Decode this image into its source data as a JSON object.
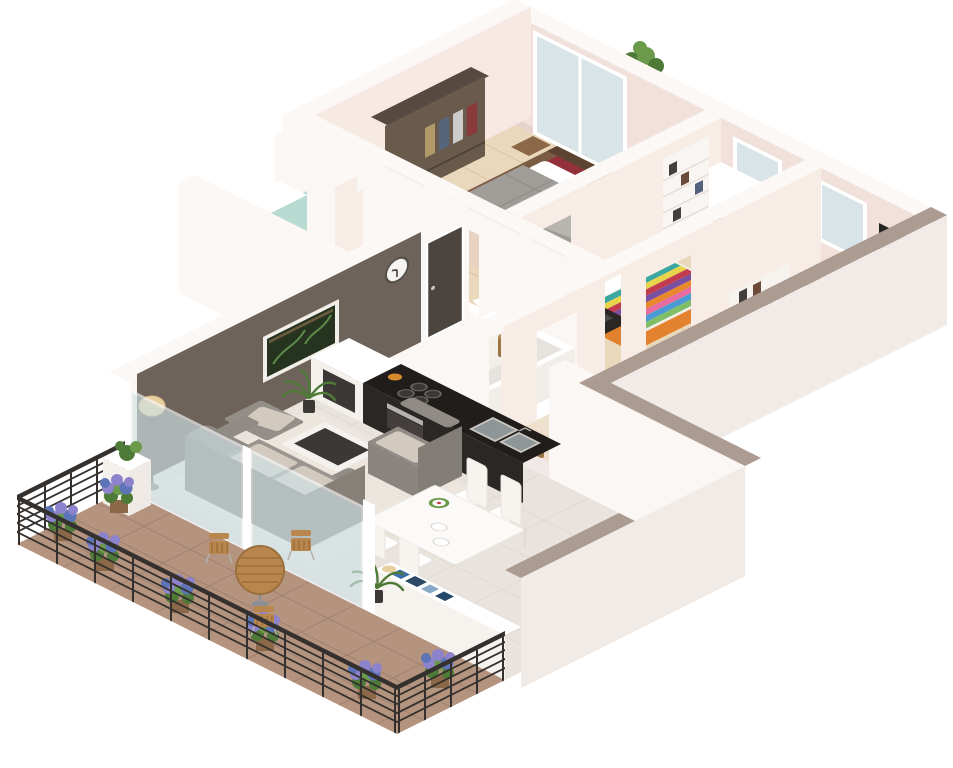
{
  "image_type": "3d-isometric-floor-plan-render",
  "title": "3 bedroom apartment 3D floor plan",
  "palette": {
    "background": "#ffffff",
    "wallTop": "#fbf8f6",
    "wallPink": "#f2e1da",
    "wallPinkLight": "#f6e9e3",
    "wallWhiteFace": "#fbf7f4",
    "wallInnerWhite": "#f8ece7",
    "accentWall": "#6e635b",
    "accentDoor": "#4c443e",
    "taupeTop": "#ab9b90",
    "extFace": "#f1ebe7",
    "wood": "#ead8bd",
    "woodLine": "#d9c09c",
    "woodLight": "#eee0cd",
    "tileCore": "#f0e9e7",
    "tileLiving": "#e9e3dd",
    "tileLine": "#ded5cd",
    "terrace": "#b5947f",
    "terraceLine": "#a18272",
    "balconyWood": "#e0caa8",
    "glass": "#cfe2e6",
    "windowGlass": "#d8e4e8",
    "railing": "#33302e",
    "counterTop": "#201d1b",
    "counterFace": "#2a2724",
    "steel": "#b5b1ad",
    "sofa": "#908b85",
    "sofaDark": "#827d77",
    "cushion": "#d2cabf",
    "duvetGray": "#a09d99",
    "bedWood": "#7a5c42",
    "redCushion": "#93303a",
    "darkRedThrow": "#6e2432",
    "duvetWhite": "#f4efe6",
    "orangeRug": "#e2812e",
    "rug": "#e6d2c2",
    "chairRed": "#c23028",
    "plantGreen": "#4e7a38",
    "plantGreenLight": "#6a9a4a",
    "lavender": "#8d83cc",
    "lavenderBlue": "#5d74b8",
    "planter": "#8a6848",
    "wicker": "#9a7644",
    "towelYellow": "#e8c23a",
    "towelOrange": "#e89c3a",
    "tealGlass": "#9ecfc4",
    "woodTable": "#b9874e",
    "lampShade": "#e8cfa0",
    "artBg": "#262620",
    "artFlower": "#9a6fd0",
    "pictureBg": "#26331f",
    "dark": "#3c3835"
  },
  "scene": {
    "projection": "isometric",
    "rooms": [
      {
        "name": "master bedroom",
        "floor": "wood",
        "items": [
          "double bed with gray duvet",
          "red headboard cushions",
          "white pillows",
          "two nightstands",
          "wardrobe with clothes",
          "small desk with yellow items",
          "sliding glass door to balcony"
        ]
      },
      {
        "name": "balcony",
        "floor": "wood",
        "items": [
          "green plant on parapet",
          "dark bin"
        ]
      },
      {
        "name": "second bedroom",
        "floor": "wood",
        "items": [
          "multicolor striped bed",
          "white pillow",
          "orange rug",
          "tall bookshelf",
          "black desk with equipment",
          "window"
        ]
      },
      {
        "name": "third bedroom",
        "floor": "wood",
        "items": [
          "double bed with white duvet",
          "dark red throw",
          "red rounded armchair",
          "low bookshelf",
          "wicker basket",
          "green plant",
          "black artwork with purple flower",
          "window"
        ]
      },
      {
        "name": "hallway",
        "floor": "tile",
        "items": [
          "entry doormat"
        ]
      },
      {
        "name": "shower room 1",
        "items": [
          "teal glass shower panel",
          "shower tray",
          "sink",
          "cabinet with yellow towels"
        ]
      },
      {
        "name": "shower room 2",
        "items": [
          "teal glass shower panel",
          "shower tray",
          "cabinet with yellow towels"
        ]
      },
      {
        "name": "bathroom",
        "items": [
          "bathtub",
          "double sink vanity",
          "toilet",
          "wicker basket",
          "wall vent grille",
          "green glass panel"
        ]
      },
      {
        "name": "kitchen",
        "items": [
          "black counter",
          "4-burner hob",
          "double stainless sink",
          "oven",
          "white cabinet with dark appliance",
          "orange canister"
        ]
      },
      {
        "name": "dining area",
        "items": [
          "white dining table",
          "4 white chairs",
          "green wreath centerpiece",
          "white plates"
        ]
      },
      {
        "name": "living room",
        "items": [
          "gray sofa with light cushions",
          "gray armchair",
          "ottoman with pillow",
          "coffee table with dark glass top",
          "floor lamp",
          "potted palm",
          "dark accent wall",
          "framed plant picture",
          "wall clock",
          "entry door"
        ]
      },
      {
        "name": "terrace",
        "floor": "brown tile grid",
        "items": [
          "black metal railing",
          "7 lavender shrubs in wood planters",
          "round wood bistro table",
          "3 wood slat chairs",
          "white planter with plant",
          "sideboard with blue books and lamp",
          "glass sliding doors"
        ]
      }
    ],
    "counts": {
      "bedrooms": 3,
      "terrace_shrubs": 7,
      "terrace_chairs": 3,
      "dining_chairs": 4,
      "facade_windows": 2
    }
  }
}
